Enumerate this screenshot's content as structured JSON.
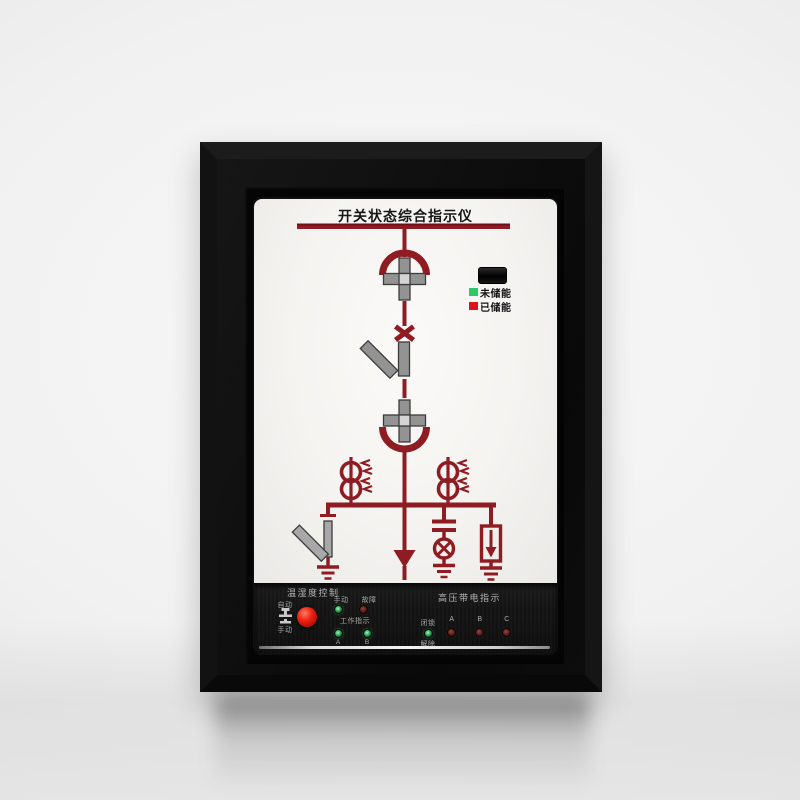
{
  "device": {
    "title": "开关状态综合指示仪",
    "legend": {
      "not_charged": "未储能",
      "charged": "已储能"
    },
    "panel": {
      "temp_humidity": "温湿度控制",
      "auto": "自动",
      "manual_btn": "手动",
      "manual_led": "手动",
      "fault": "故障",
      "work_indicator": "工作指示",
      "work_a": "A",
      "work_b": "B",
      "hv_live": "高压带电指示",
      "lock": "闭锁",
      "release": "解除",
      "phase_a": "A",
      "phase_b": "B",
      "phase_c": "C"
    },
    "colors": {
      "diagram_red": "#8e1c22",
      "legend_green": "#2bc96a",
      "legend_red": "#df1020",
      "button_red": "#f02313",
      "led_green_on": "#35b35f",
      "led_red_dim": "#541a14",
      "frame_black": "#101010",
      "panel_white": "#f5f4f1"
    }
  }
}
